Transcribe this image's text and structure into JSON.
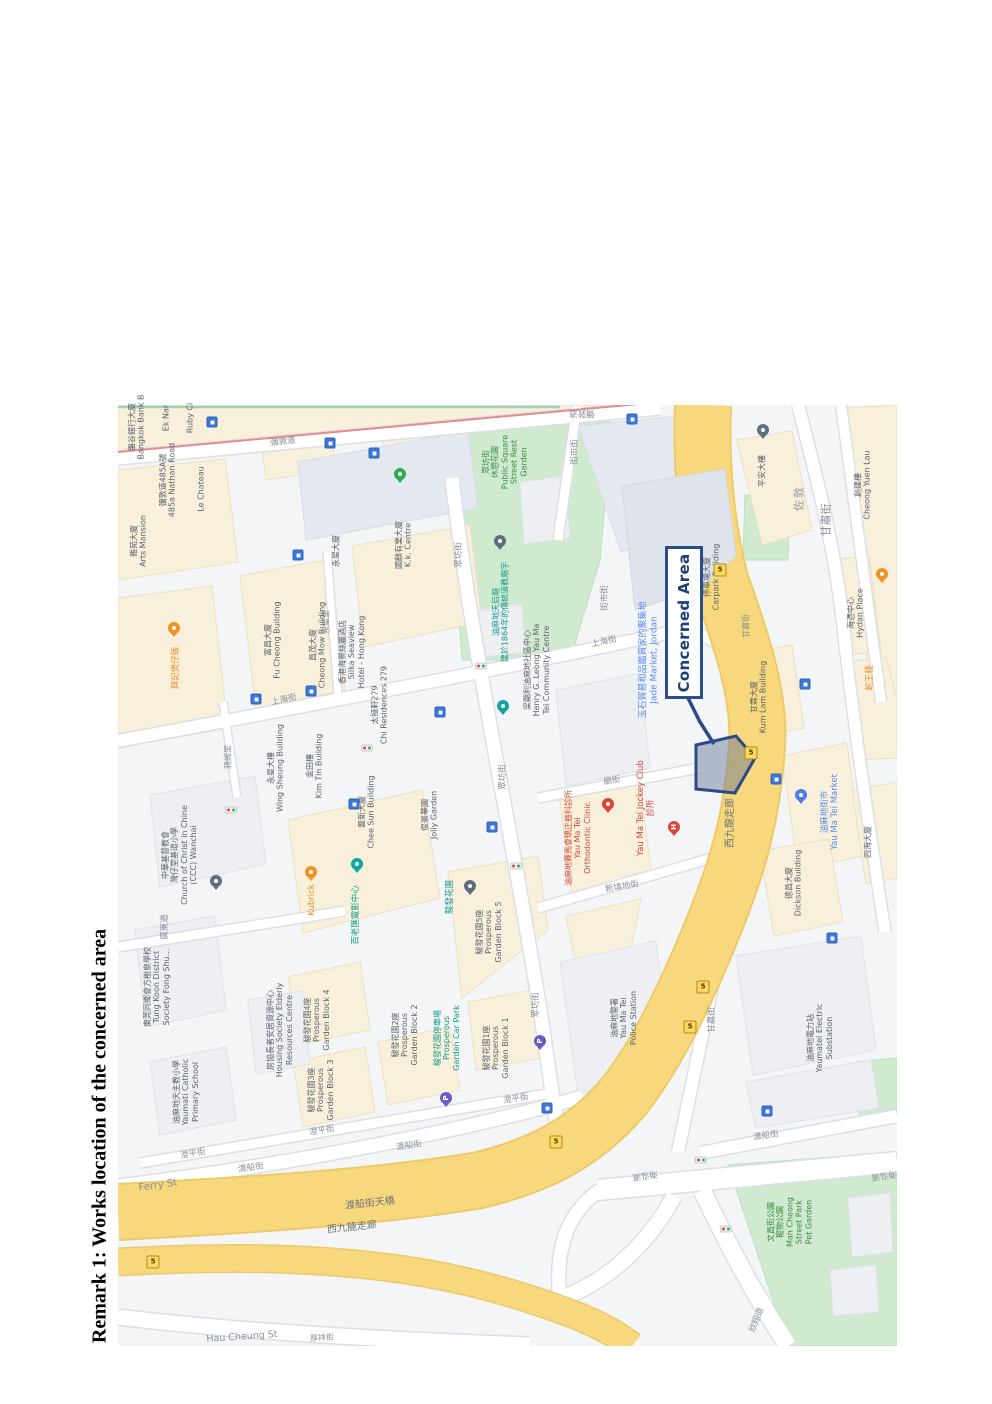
{
  "document": {
    "remark_title": "Remark 1: Works location of the concerned area"
  },
  "map": {
    "concerned_area": {
      "label": "Concerned Area",
      "border_color": "#2b4d8c",
      "text_color": "#1d3f77",
      "polygon_fill": "rgba(96,114,148,0.45)"
    },
    "colors": {
      "road_major": "#f7d87c",
      "road_major_casing": "#eec96a",
      "park": "#cfeacf",
      "block": "#faf2da",
      "poi_teal": "#0f9b8e",
      "poi_orange": "#ef8e1f",
      "poi_blue": "#5b8df0",
      "poi_red": "#d5473a",
      "transit_badge": "#3c78dc"
    },
    "labels": [
      {
        "t": "彌敦道",
        "x": 283,
        "y": 442,
        "r": -6,
        "c": "st"
      },
      {
        "t": "彌敦道",
        "x": 582,
        "y": 413,
        "r": 180,
        "c": "st"
      },
      {
        "t": "街市街",
        "x": 575,
        "y": 452,
        "r": -90,
        "c": "st"
      },
      {
        "t": "街市街",
        "x": 605,
        "y": 598,
        "r": -90,
        "c": "st"
      },
      {
        "t": "上海街",
        "x": 284,
        "y": 700,
        "r": -12,
        "c": "st"
      },
      {
        "t": "上海街",
        "x": 604,
        "y": 642,
        "r": -12,
        "c": "st"
      },
      {
        "t": "永星里",
        "x": 326,
        "y": 622,
        "r": -90,
        "c": "st",
        "s": 8
      },
      {
        "t": "鴉緗里",
        "x": 228,
        "y": 757,
        "r": -90,
        "c": "st",
        "s": 8
      },
      {
        "t": "廟街",
        "x": 612,
        "y": 781,
        "r": -10,
        "c": "st"
      },
      {
        "t": "新填地街",
        "x": 622,
        "y": 887,
        "r": -10,
        "c": "st"
      },
      {
        "t": "廣東道",
        "x": 165,
        "y": 927,
        "r": -90,
        "c": "st"
      },
      {
        "t": "眾坊街",
        "x": 459,
        "y": 555,
        "r": -90,
        "c": "st"
      },
      {
        "t": "眾坊街",
        "x": 503,
        "y": 777,
        "r": -90,
        "c": "st"
      },
      {
        "t": "眾坊街",
        "x": 536,
        "y": 1005,
        "r": -90,
        "c": "st"
      },
      {
        "t": "甘肅街",
        "x": 827,
        "y": 520,
        "r": -90,
        "c": "st",
        "s": 11
      },
      {
        "t": "甘肅街",
        "x": 746,
        "y": 626,
        "r": -90,
        "c": "st",
        "s": 8
      },
      {
        "t": "甘肅街",
        "x": 712,
        "y": 1020,
        "r": -90,
        "c": "st"
      },
      {
        "t": "澄平街",
        "x": 193,
        "y": 1154,
        "r": -10,
        "c": "st"
      },
      {
        "t": "澄平街",
        "x": 322,
        "y": 1131,
        "r": -10,
        "c": "st"
      },
      {
        "t": "澄平街",
        "x": 516,
        "y": 1099,
        "r": -10,
        "c": "st"
      },
      {
        "t": "渡船街",
        "x": 251,
        "y": 1168,
        "r": -8,
        "c": "st"
      },
      {
        "t": "渡船街",
        "x": 409,
        "y": 1146,
        "r": -8,
        "c": "st"
      },
      {
        "t": "Ferry St",
        "x": 158,
        "y": 1186,
        "r": -8,
        "c": "st",
        "s": 10
      },
      {
        "t": "渡船街",
        "x": 766,
        "y": 1136,
        "r": -8,
        "c": "st"
      },
      {
        "t": "海泓道",
        "x": 645,
        "y": 1175,
        "r": 172,
        "c": "st"
      },
      {
        "t": "海泓道",
        "x": 884,
        "y": 1175,
        "r": 172,
        "c": "st"
      },
      {
        "t": "欣翔道",
        "x": 757,
        "y": 1320,
        "r": -68,
        "c": "st"
      },
      {
        "t": "Hau Cheung St",
        "x": 242,
        "y": 1337,
        "r": -4,
        "c": "st",
        "s": 9.5
      },
      {
        "t": "厚祥街",
        "x": 322,
        "y": 1338,
        "r": -4,
        "c": "st",
        "s": 8
      },
      {
        "t": "渡船街天橋",
        "x": 370,
        "y": 1204,
        "r": -6,
        "c": "ro",
        "s": 10
      },
      {
        "t": "西九龍走廊",
        "x": 352,
        "y": 1228,
        "r": -6,
        "c": "ro",
        "s": 10
      },
      {
        "t": "西九龍走廊",
        "x": 731,
        "y": 823,
        "r": -90,
        "c": "ro",
        "s": 10
      },
      {
        "t": "佐敦",
        "x": 800,
        "y": 498,
        "r": -90,
        "c": "di",
        "s": 11
      },
      {
        "t": "眾坊街\n休憩花園\nPublic Square\nStreet Rest\nGarden",
        "x": 505,
        "y": 462,
        "r": -90,
        "c": "pk",
        "s": 8
      },
      {
        "t": "文昌街公園\n寵物公園\nMan Cheong\nStreet Park\nPet Garden",
        "x": 790,
        "y": 1222,
        "r": -90,
        "c": "pk",
        "s": 8
      },
      {
        "t": "油麻地天后廟\n建於1864年的傳統道教廟宇",
        "x": 501,
        "y": 612,
        "r": -90,
        "c": "tl",
        "s": 8
      },
      {
        "t": "百老匯電影中心",
        "x": 356,
        "y": 915,
        "r": -90,
        "c": "tl"
      },
      {
        "t": "駿發花園",
        "x": 450,
        "y": 897,
        "r": -90,
        "c": "tl"
      },
      {
        "t": "駿發花園停車場\nProsperous\nGarden Car Park",
        "x": 447,
        "y": 1038,
        "r": -90,
        "c": "tl",
        "s": 8
      },
      {
        "t": "興記煲仔飯",
        "x": 176,
        "y": 668,
        "r": -90,
        "c": "or"
      },
      {
        "t": "Kubrick",
        "x": 312,
        "y": 900,
        "r": -90,
        "c": "or"
      },
      {
        "t": "蛇王棧",
        "x": 870,
        "y": 678,
        "r": -90,
        "c": "or"
      },
      {
        "t": "玉石貿易和品鑑賞家的聚集地\nJade Market, Jordan",
        "x": 649,
        "y": 660,
        "r": -90,
        "c": "bu",
        "s": 9
      },
      {
        "t": "油麻地街市\nYau Ma Tei Market",
        "x": 830,
        "y": 812,
        "r": -90,
        "c": "bu"
      },
      {
        "t": "油麻地賽馬會矯正齒科診所\nYau Ma Tei\nOrthodontic Clinic",
        "x": 578,
        "y": 838,
        "r": -90,
        "c": "rd",
        "s": 8
      },
      {
        "t": "Yau Ma Tei Jockey Club\n診所",
        "x": 646,
        "y": 808,
        "r": -90,
        "c": "rd",
        "s": 8.5
      },
      {
        "t": "盤谷銀行大廈\nBangkok Bank B",
        "x": 137,
        "y": 427,
        "r": -90,
        "c": "bl",
        "s": 8
      },
      {
        "t": "Ek Nar",
        "x": 166,
        "y": 418,
        "r": -90,
        "c": "bl",
        "s": 8
      },
      {
        "t": "Ruby Ci",
        "x": 190,
        "y": 418,
        "r": -90,
        "c": "bl",
        "s": 8
      },
      {
        "t": "彌敦道485A號\n485a Nathan Road",
        "x": 168,
        "y": 480,
        "r": -90,
        "c": "bl",
        "s": 8
      },
      {
        "t": "Le Chateau",
        "x": 201,
        "y": 489,
        "r": -90,
        "c": "bl",
        "s": 8
      },
      {
        "t": "雅苑大廈\nArts Mansion",
        "x": 139,
        "y": 541,
        "r": -90,
        "c": "bl",
        "s": 8
      },
      {
        "t": "富昌大廈\nFu Cheong Building",
        "x": 273,
        "y": 640,
        "r": -90,
        "c": "bl",
        "s": 8
      },
      {
        "t": "昌茂大廈\nCheong Mow Building",
        "x": 318,
        "y": 645,
        "r": -90,
        "c": "bl",
        "s": 8
      },
      {
        "t": "香港海景絲麗酒店\nSilka Seaview\nHotel - Hong Kong",
        "x": 352,
        "y": 652,
        "r": -90,
        "c": "bl",
        "s": 8
      },
      {
        "t": "太極軒279\nChi Residences 279",
        "x": 380,
        "y": 705,
        "r": -90,
        "c": "bl",
        "s": 8
      },
      {
        "t": "永星大廈",
        "x": 336,
        "y": 551,
        "r": -90,
        "c": "bl",
        "s": 8
      },
      {
        "t": "國麒有業大廈\nK.k. Centre",
        "x": 404,
        "y": 545,
        "r": -90,
        "c": "bl",
        "s": 8
      },
      {
        "t": "永星大樓\nWing Sheung Building",
        "x": 276,
        "y": 768,
        "r": -90,
        "c": "bl",
        "s": 8
      },
      {
        "t": "金田樓\nKim Tin Building",
        "x": 315,
        "y": 766,
        "r": -90,
        "c": "bl",
        "s": 8
      },
      {
        "t": "置新大廈\nChee Sun Building",
        "x": 367,
        "y": 812,
        "r": -90,
        "c": "bl",
        "s": 8
      },
      {
        "t": "俊景華園\nJolly Garden",
        "x": 430,
        "y": 815,
        "r": -90,
        "c": "bl",
        "s": 8
      },
      {
        "t": "中華基督教會\n灣仔堂基道小學\nChurch of Christ in Chine\n(CCC) Wanchai",
        "x": 180,
        "y": 855,
        "r": -90,
        "c": "bl",
        "s": 8
      },
      {
        "t": "梁顯利油麻地社區中心\nHenry G. Leong Yau Ma\nTei Community Centre",
        "x": 537,
        "y": 670,
        "r": -90,
        "c": "bl",
        "s": 8
      },
      {
        "t": "駿發花園5座\nProsperous\nGarden Block 5",
        "x": 489,
        "y": 932,
        "r": -90,
        "c": "bl",
        "s": 8
      },
      {
        "t": "東莞同鄉會方樹泉學校\nTung Koon District\nSociety Fong Shu...",
        "x": 157,
        "y": 987,
        "r": -90,
        "c": "bl",
        "s": 8
      },
      {
        "t": "房協長者安居資源中心\nHousing Society Elderly\nResources Centre",
        "x": 280,
        "y": 1030,
        "r": -90,
        "c": "bl",
        "s": 8
      },
      {
        "t": "駿發花園4座\nProsperous\nGarden Block 4",
        "x": 317,
        "y": 1020,
        "r": -90,
        "c": "bl",
        "s": 8
      },
      {
        "t": "駿發花園3座\nProsperous\nGarden Block 3",
        "x": 321,
        "y": 1090,
        "r": -90,
        "c": "bl",
        "s": 8
      },
      {
        "t": "駿發花園2座\nProsperous\nGarden Block 2",
        "x": 405,
        "y": 1035,
        "r": -90,
        "c": "bl",
        "s": 8
      },
      {
        "t": "駿發花園1座\nProsperous\nGarden Block 1",
        "x": 496,
        "y": 1048,
        "r": -90,
        "c": "bl",
        "s": 8
      },
      {
        "t": "油麻地天主教小學\nYaumati Catholic\nPrimary School",
        "x": 186,
        "y": 1092,
        "r": -90,
        "c": "bl",
        "s": 8
      },
      {
        "t": "平安大樓",
        "x": 762,
        "y": 471,
        "r": -90,
        "c": "bl",
        "s": 8
      },
      {
        "t": "創建樓\nCheong Yuen Lau",
        "x": 863,
        "y": 485,
        "r": -90,
        "c": "bl",
        "s": 8
      },
      {
        "t": "海憑中心\nHydan Place",
        "x": 856,
        "y": 613,
        "r": -90,
        "c": "bl",
        "s": 8
      },
      {
        "t": "甘霖大廈\nKum Lam Building",
        "x": 759,
        "y": 697,
        "r": -90,
        "c": "bl",
        "s": 8
      },
      {
        "t": "德昌大廈\nDickson Building",
        "x": 794,
        "y": 883,
        "r": -90,
        "c": "bl",
        "s": 8
      },
      {
        "t": "油麻地警署\nYau Ma Tei\nPolice Station",
        "x": 624,
        "y": 1018,
        "r": -90,
        "c": "bl",
        "s": 8
      },
      {
        "t": "油麻地電力站\nYaumatei Electric\nSubstation",
        "x": 820,
        "y": 1038,
        "r": -90,
        "c": "bl",
        "s": 8
      },
      {
        "t": "停車場大廈\nCarpark Building",
        "x": 712,
        "y": 577,
        "r": -90,
        "c": "bl",
        "s": 8
      },
      {
        "t": "四海大廈",
        "x": 868,
        "y": 842,
        "r": -90,
        "c": "bl",
        "s": 8
      }
    ],
    "pins": [
      {
        "x": 500,
        "y": 545,
        "c": "slate"
      },
      {
        "x": 503,
        "y": 710,
        "c": "teal"
      },
      {
        "x": 357,
        "y": 868,
        "c": "teal"
      },
      {
        "x": 216,
        "y": 885,
        "c": "slate"
      },
      {
        "x": 470,
        "y": 890,
        "c": "slate"
      },
      {
        "x": 763,
        "y": 434,
        "c": "slate"
      },
      {
        "x": 400,
        "y": 478,
        "c": "green"
      },
      {
        "x": 174,
        "y": 632,
        "c": "orange"
      },
      {
        "x": 311,
        "y": 876,
        "c": "orange"
      },
      {
        "x": 882,
        "y": 578,
        "c": "orange"
      },
      {
        "x": 608,
        "y": 808,
        "c": "red"
      },
      {
        "x": 674,
        "y": 831,
        "c": "red",
        "g": "H"
      },
      {
        "x": 801,
        "y": 799,
        "c": "blue"
      },
      {
        "x": 540,
        "y": 1045,
        "c": "purple",
        "g": "P"
      },
      {
        "x": 446,
        "y": 1102,
        "c": "purple",
        "g": "P"
      }
    ],
    "transit_badges": [
      [
        212,
        422
      ],
      [
        330,
        443
      ],
      [
        374,
        453
      ],
      [
        632,
        419
      ],
      [
        298,
        555
      ],
      [
        440,
        712
      ],
      [
        256,
        699
      ],
      [
        311,
        691
      ],
      [
        354,
        804
      ],
      [
        492,
        827
      ],
      [
        832,
        938
      ],
      [
        767,
        1111
      ],
      [
        547,
        1108
      ],
      [
        776,
        779
      ],
      [
        805,
        684
      ]
    ],
    "traffic_lights": [
      [
        231,
        810
      ],
      [
        367,
        748
      ],
      [
        481,
        666
      ],
      [
        516,
        866
      ],
      [
        701,
        1160
      ],
      [
        726,
        1229
      ]
    ],
    "route_shields": [
      {
        "x": 720,
        "y": 570,
        "t": "5"
      },
      {
        "x": 751,
        "y": 753,
        "t": "5"
      },
      {
        "x": 703,
        "y": 987,
        "t": "5"
      },
      {
        "x": 690,
        "y": 1027,
        "t": "5"
      },
      {
        "x": 556,
        "y": 1142,
        "t": "5"
      },
      {
        "x": 153,
        "y": 1262,
        "t": "5"
      }
    ]
  }
}
